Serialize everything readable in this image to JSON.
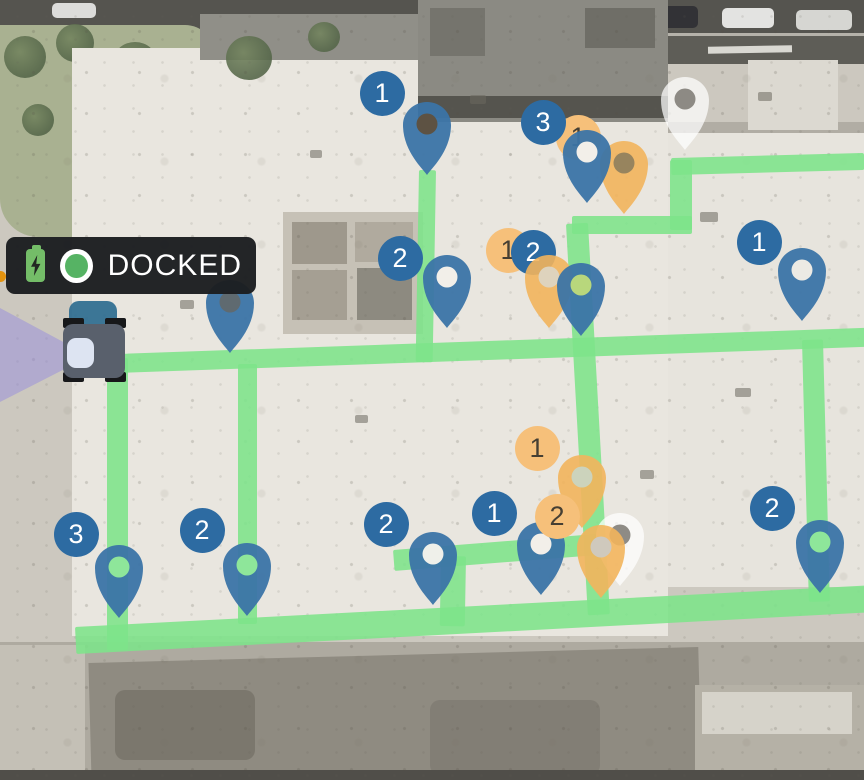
{
  "status_pill": {
    "label": "DOCKED",
    "status_dot_color": "#56b364",
    "battery": {
      "state": "charging",
      "color": "#74bd68"
    }
  },
  "robot": {
    "state": "docked",
    "fov_color": "rgba(150,140,222,0.5)",
    "head_color": "#2e6d90"
  },
  "map": {
    "style": "satellite"
  },
  "colors": {
    "pin_blue": "#3b74a6",
    "pin_orange": "#f2b45c",
    "pin_ghost": "rgba(255,255,255,0.72)",
    "ghost_hole": "rgba(123,120,113,0.85)",
    "badge_blue": "#2d6ba2",
    "badge_orange": "#f6c07a",
    "badge_orange_text": "#463f33",
    "path_green": "rgba(125,228,138,0.88)"
  },
  "path": {
    "segments": [
      {
        "x": 419,
        "y": 170,
        "w": 17,
        "h": 192,
        "rot": 1
      },
      {
        "x": 88,
        "y": 355,
        "w": 780,
        "h": 19,
        "rot": -2
      },
      {
        "x": 107,
        "y": 358,
        "w": 21,
        "h": 292,
        "rot": 0
      },
      {
        "x": 238,
        "y": 364,
        "w": 19,
        "h": 260,
        "rot": 0
      },
      {
        "x": 566,
        "y": 224,
        "w": 22,
        "h": 392,
        "rot": -3.2
      },
      {
        "x": 572,
        "y": 216,
        "w": 120,
        "h": 18,
        "rot": 0
      },
      {
        "x": 670,
        "y": 160,
        "w": 22,
        "h": 70,
        "rot": 0
      },
      {
        "x": 671,
        "y": 158,
        "w": 193,
        "h": 17,
        "rot": -1.5
      },
      {
        "x": 393,
        "y": 550,
        "w": 212,
        "h": 21,
        "rot": -4.5
      },
      {
        "x": 441,
        "y": 556,
        "w": 25,
        "h": 70,
        "rot": 1
      },
      {
        "x": 802,
        "y": 340,
        "w": 21,
        "h": 262,
        "rot": -1.5
      },
      {
        "x": 75,
        "y": 627,
        "w": 800,
        "h": 27,
        "rot": -3
      }
    ]
  },
  "markers": [
    {
      "kind": "ghost",
      "x": 685,
      "y": 152
    },
    {
      "kind": "badge",
      "color": "orange",
      "label": "1",
      "x": 578,
      "y": 137
    },
    {
      "kind": "badge",
      "color": "blue",
      "label": "3",
      "x": 543,
      "y": 122
    },
    {
      "kind": "pin",
      "color": "orange",
      "x": 624,
      "y": 216,
      "hole": "#97845e"
    },
    {
      "kind": "pin",
      "color": "blue",
      "x": 587,
      "y": 205,
      "hole": "#f2efe9"
    },
    {
      "kind": "pin",
      "color": "blue",
      "x": 427,
      "y": 177,
      "hole": "#5d5243"
    },
    {
      "kind": "badge",
      "color": "blue",
      "label": "1",
      "x": 382,
      "y": 93
    },
    {
      "kind": "pin",
      "color": "blue",
      "x": 230,
      "y": 355,
      "hole": "#5f6a70"
    },
    {
      "kind": "pin",
      "color": "blue",
      "x": 447,
      "y": 330,
      "hole": "#f2efe9"
    },
    {
      "kind": "badge",
      "color": "blue",
      "label": "2",
      "x": 400,
      "y": 258
    },
    {
      "kind": "badge",
      "color": "orange",
      "label": "1",
      "x": 508,
      "y": 250
    },
    {
      "kind": "badge",
      "color": "blue",
      "label": "2",
      "x": 533,
      "y": 252
    },
    {
      "kind": "pin",
      "color": "orange",
      "x": 549,
      "y": 330,
      "hole": "#ded3bd"
    },
    {
      "kind": "pin",
      "color": "blue",
      "x": 581,
      "y": 338,
      "hole": "#b8d77c"
    },
    {
      "kind": "pin",
      "color": "blue",
      "x": 802,
      "y": 323,
      "hole": "#eceae4"
    },
    {
      "kind": "badge",
      "color": "blue",
      "label": "1",
      "x": 759,
      "y": 242
    },
    {
      "kind": "badge",
      "color": "orange",
      "label": "1",
      "x": 537,
      "y": 448
    },
    {
      "kind": "pin",
      "color": "orange",
      "x": 582,
      "y": 530,
      "hole": "#ccd3bc"
    },
    {
      "kind": "ghost",
      "x": 620,
      "y": 588
    },
    {
      "kind": "pin",
      "color": "orange",
      "x": 601,
      "y": 600,
      "hole": "#cfc9bd"
    },
    {
      "kind": "pin",
      "color": "blue",
      "x": 541,
      "y": 597,
      "hole": "#f2efe9"
    },
    {
      "kind": "badge",
      "color": "blue",
      "label": "1",
      "x": 494,
      "y": 513
    },
    {
      "kind": "badge",
      "color": "orange",
      "label": "2",
      "x": 557,
      "y": 516
    },
    {
      "kind": "pin",
      "color": "blue",
      "x": 119,
      "y": 620,
      "hole": "#8ee69a"
    },
    {
      "kind": "badge",
      "color": "blue",
      "label": "3",
      "x": 76,
      "y": 534
    },
    {
      "kind": "pin",
      "color": "blue",
      "x": 247,
      "y": 618,
      "hole": "#8ee69a"
    },
    {
      "kind": "badge",
      "color": "blue",
      "label": "2",
      "x": 202,
      "y": 530
    },
    {
      "kind": "pin",
      "color": "blue",
      "x": 433,
      "y": 607,
      "hole": "#eff0ea"
    },
    {
      "kind": "badge",
      "color": "blue",
      "label": "2",
      "x": 386,
      "y": 524
    },
    {
      "kind": "pin",
      "color": "blue",
      "x": 820,
      "y": 595,
      "hole": "#8ee69a"
    },
    {
      "kind": "badge",
      "color": "blue",
      "label": "2",
      "x": 772,
      "y": 508
    }
  ]
}
